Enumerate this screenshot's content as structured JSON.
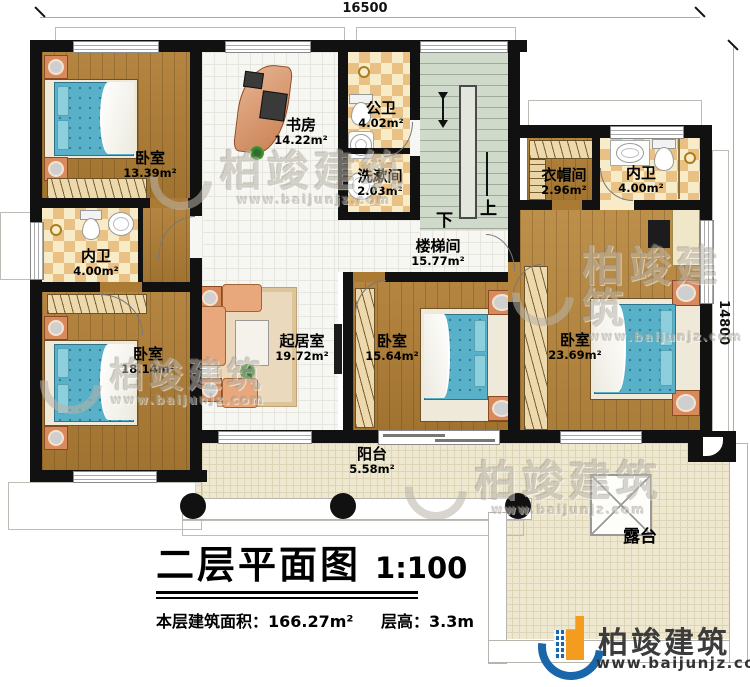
{
  "plan": {
    "title": "二层平面图",
    "scale": "1:100",
    "stats_area_label": "本层建筑面积：",
    "stats_area_value": "166.27m²",
    "stats_height_label": "层高：",
    "stats_height_value": "3.3m",
    "dim_top": "16500",
    "dim_right": "14800",
    "stair_down": "下",
    "stair_up": "上"
  },
  "rooms": [
    {
      "id": "bedroom-top-left",
      "name": "卧室",
      "area": "13.39m²"
    },
    {
      "id": "study",
      "name": "书房",
      "area": "14.22m²"
    },
    {
      "id": "public-bath",
      "name": "公卫",
      "area": "4.02m²"
    },
    {
      "id": "washroom",
      "name": "洗漱间",
      "area": "2.03m²"
    },
    {
      "id": "stairwell",
      "name": "楼梯间",
      "area": "15.77m²"
    },
    {
      "id": "cloakroom",
      "name": "衣帽间",
      "area": "2.96m²"
    },
    {
      "id": "ensuite-right",
      "name": "内卫",
      "area": "4.00m²"
    },
    {
      "id": "ensuite-left",
      "name": "内卫",
      "area": "4.00m²"
    },
    {
      "id": "bedroom-bottom-left",
      "name": "卧室",
      "area": "18.14m²"
    },
    {
      "id": "living-room",
      "name": "起居室",
      "area": "19.72m²"
    },
    {
      "id": "bedroom-middle",
      "name": "卧室",
      "area": "15.64m²"
    },
    {
      "id": "bedroom-right",
      "name": "卧室",
      "area": "23.69m²"
    },
    {
      "id": "balcony",
      "name": "阳台",
      "area": "5.58m²"
    },
    {
      "id": "terrace",
      "name": "露台"
    }
  ],
  "branding": {
    "company": "柏竣建筑",
    "website": "www.baijunjz.com"
  },
  "watermark": {
    "text": "柏竣建筑",
    "url": "www.baijunjz.com"
  },
  "colors": {
    "wall": "#111111",
    "wood": "#ab7a33",
    "tile_light": "#f8ecc8",
    "tile_dark": "#e9c185",
    "indoor_white": "#f6f6f2",
    "stairs": "#cfdacb",
    "outdoor": "#eee8d0",
    "mattress": "#58b1c8",
    "furniture_orange": "#d98a5d",
    "logo_blue": "#1a66ab",
    "logo_orange": "#f49c1e"
  }
}
